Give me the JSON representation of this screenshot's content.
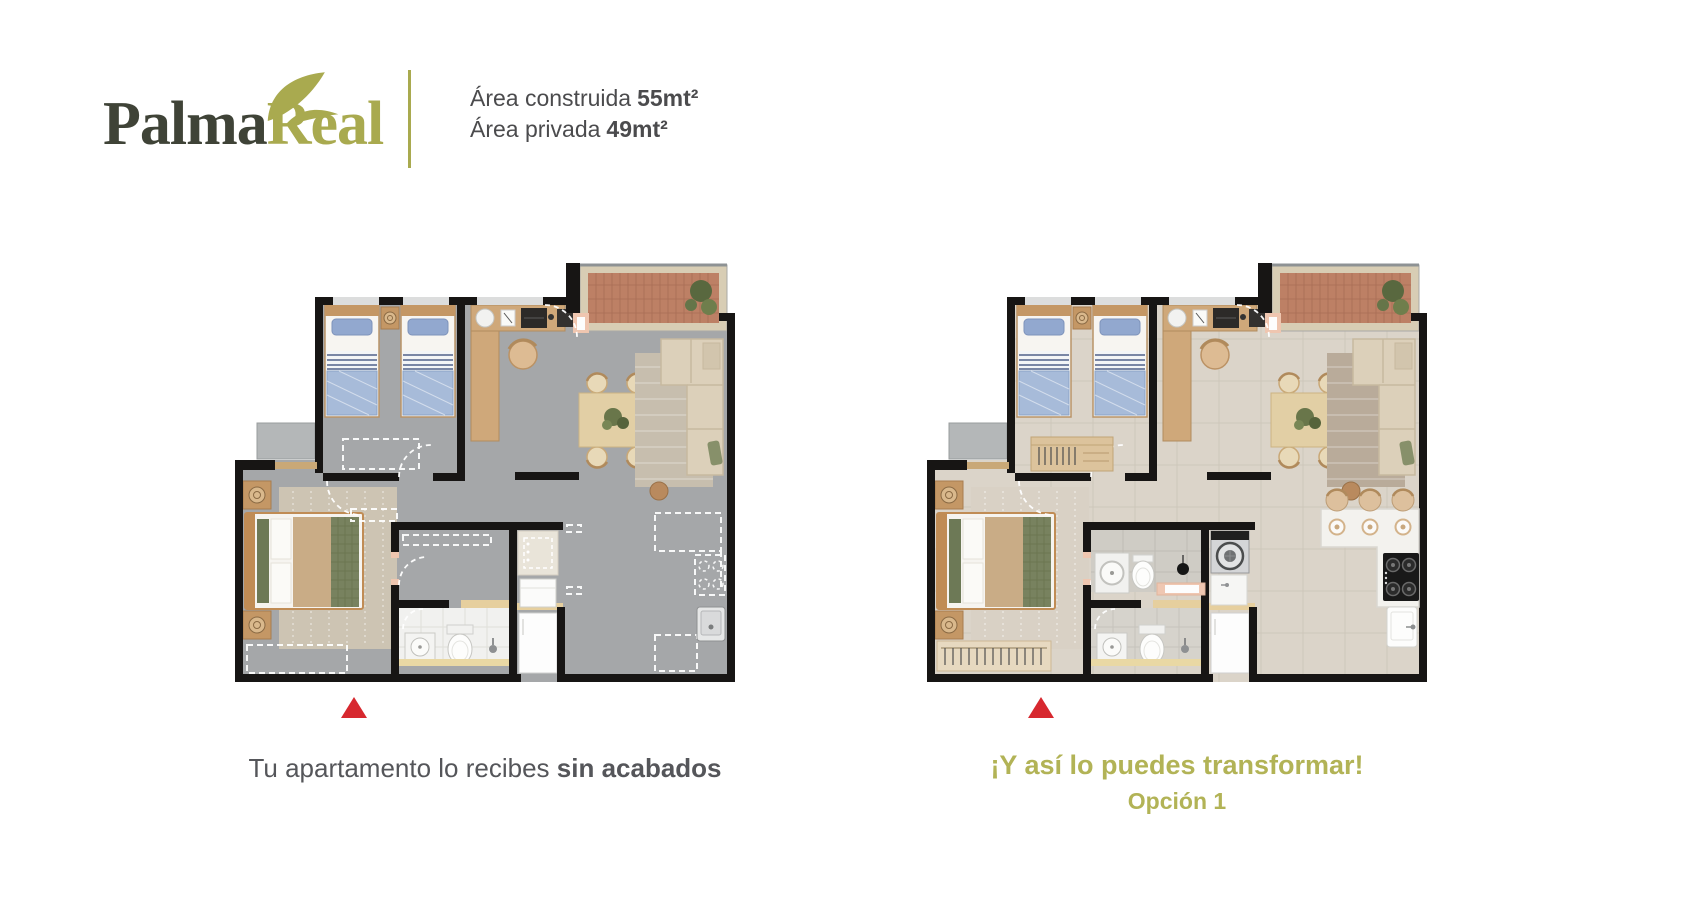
{
  "colors": {
    "accent": "#a9aa4f",
    "accent-caption": "#b2b356",
    "brand-dark": "#3f4337",
    "text-gray": "#55565a",
    "text-dark": "#4b4b4d",
    "marker-red": "#d7282f",
    "wall": "#171514",
    "floor-unfinished": "#a5a7a9",
    "floor-finished": "#dbd4c9"
  },
  "header": {
    "logo": {
      "text_primary": "Palma",
      "text_secondary": "Real",
      "icon": "palm-leaf"
    },
    "areas": [
      {
        "label": "Área construida",
        "value": "55mt²"
      },
      {
        "label": "Área privada",
        "value": "49mt²"
      }
    ]
  },
  "plans": [
    {
      "id": "as-delivered",
      "caption": {
        "regular": "Tu apartamento lo recibes ",
        "bold": "sin acabados"
      },
      "marker": "red-triangle"
    },
    {
      "id": "option-1",
      "caption_line1": "¡Y así lo puedes transformar!",
      "caption_line2": "Opción 1",
      "marker": "red-triangle"
    }
  ]
}
